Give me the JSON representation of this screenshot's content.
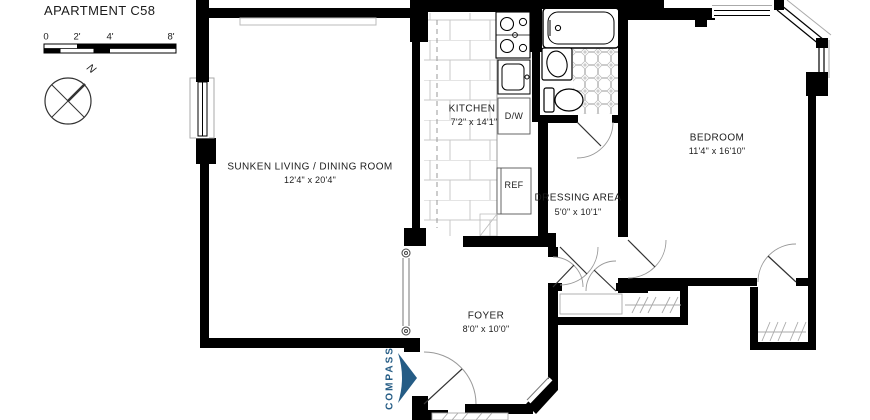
{
  "header": {
    "title": "APARTMENT C58"
  },
  "scale_bar": {
    "tick_labels": [
      "0",
      "2'",
      "4'",
      "8'"
    ]
  },
  "compass_rose": {
    "north_label": "N"
  },
  "rooms": {
    "living": {
      "name": "SUNKEN LIVING / DINING ROOM",
      "dims": "12'4\" x 20'4\""
    },
    "kitchen": {
      "name": "KITCHEN",
      "dims": "7'2\" x 14'1\""
    },
    "dressing": {
      "name": "DRESSING AREA",
      "dims": "5'0\" x 10'1\""
    },
    "bedroom": {
      "name": "BEDROOM",
      "dims": "11'4\" x 16'10\""
    },
    "foyer": {
      "name": "FOYER",
      "dims": "8'0\" x 10'0\""
    }
  },
  "labels": {
    "dishwasher": "D/W",
    "refrigerator": "REF"
  },
  "branding": {
    "logo_text": "COMPASS",
    "logo_color": "#255C85"
  },
  "colors": {
    "walls": "#000000",
    "background": "#FFFFFF"
  }
}
